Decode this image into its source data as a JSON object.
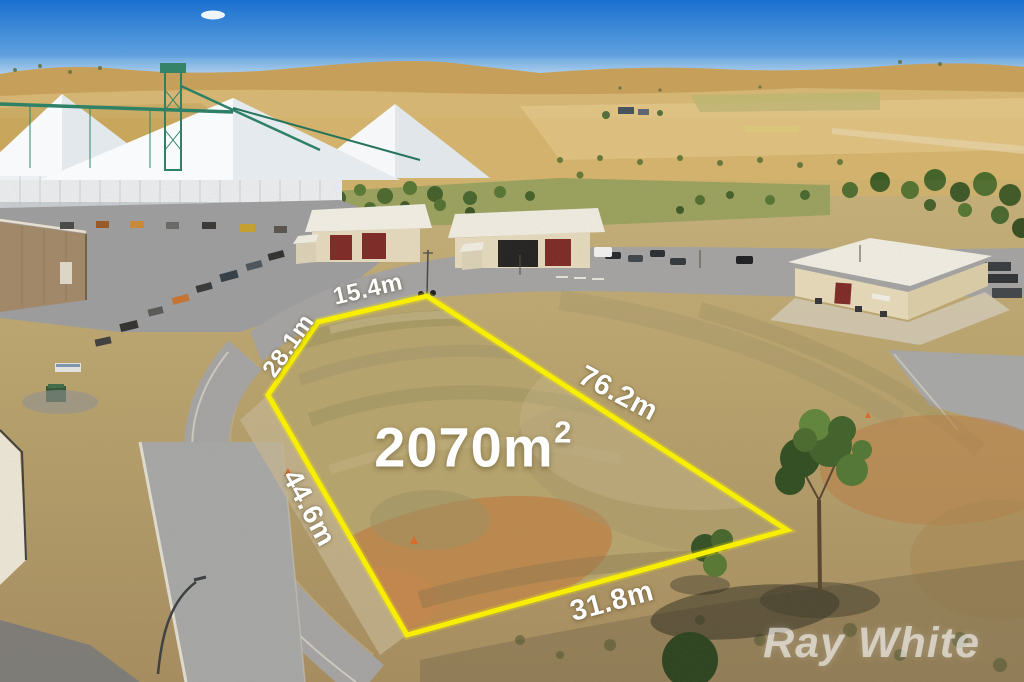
{
  "listing": {
    "area": {
      "value": "2070m",
      "superscript": "2"
    },
    "dimensions": [
      {
        "side": "top",
        "label": "15.4m"
      },
      {
        "side": "upper-left",
        "label": "28.1m"
      },
      {
        "side": "right",
        "label": "76.2m"
      },
      {
        "side": "lower-left",
        "label": "44.6m"
      },
      {
        "side": "bottom",
        "label": "31.8m"
      }
    ],
    "boundary_color": "#F7EE00",
    "label_color": "#FFFFFF"
  },
  "watermark": {
    "text": "Ray White",
    "color": "#FFFFFF"
  },
  "scene_colors": {
    "sky_top": "#1A70CF",
    "sky_horizon": "#CFE2EF",
    "hills": "#C9A75F",
    "lot_dirt": "#B7A46C",
    "orange_dirt": "#BF7C3E",
    "asphalt": "#A3A3A4",
    "vegetation": "#4C6A2C",
    "silo_white": "#F5F7F9",
    "shed_wall": "#E8DCBC",
    "shed_door": "#7C2422",
    "conveyor_green": "#2E8066"
  }
}
